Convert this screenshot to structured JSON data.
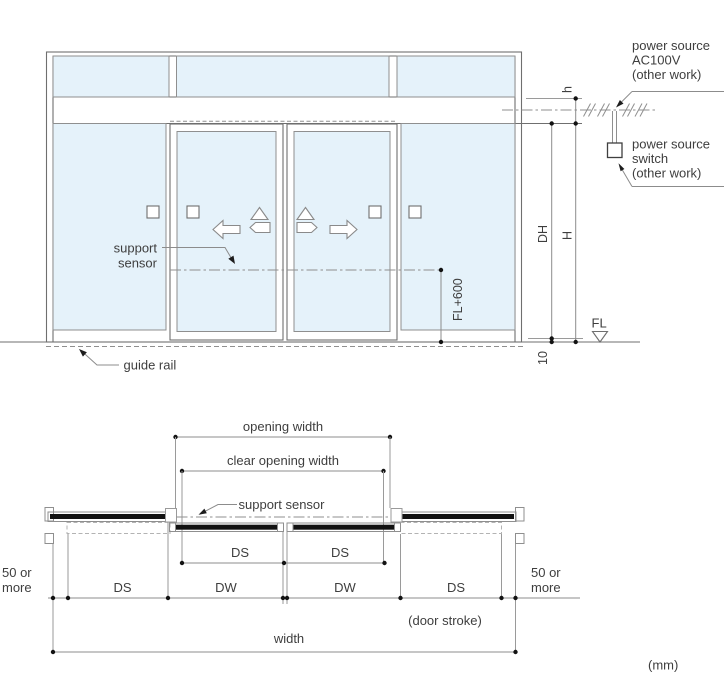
{
  "page": {
    "unit_note": "(mm)"
  },
  "elevation": {
    "power_source_label": {
      "line1": "power source",
      "line2": "AC100V",
      "line3": "(other work)"
    },
    "power_switch_label": {
      "line1": "power source",
      "line2": "switch",
      "line3": "(other work)"
    },
    "support_sensor_label": {
      "line1": "support",
      "line2": "sensor"
    },
    "guide_rail_label": "guide rail",
    "fl600_label": "FL+600",
    "fl_label": "FL",
    "dims": {
      "header_height": "h",
      "door_height": "DH",
      "opening_height": "H",
      "floor_gap": "10"
    }
  },
  "plan": {
    "opening_width_label": "opening width",
    "clear_opening_width_label": "clear opening width",
    "support_sensor_label": "support sensor",
    "dims": {
      "ds_upper_left": "DS",
      "ds_upper_right": "DS",
      "ds_lower_left": "DS",
      "dw_left": "DW",
      "dw_right": "DW",
      "ds_lower_right": "DS",
      "clearance_left": {
        "line1": "50 or",
        "line2": "more"
      },
      "clearance_right": {
        "line1": "50 or",
        "line2": "more"
      },
      "door_stroke_note": "(door stroke)",
      "width_label": "width"
    }
  },
  "colors": {
    "background": "#ffffff",
    "glass": "#e5f2fa",
    "line": "#6f6f6f",
    "line_light": "#8f8f8f",
    "dim": "#8c8c8c",
    "ink": "#121212",
    "text": "#3e3e3e"
  }
}
